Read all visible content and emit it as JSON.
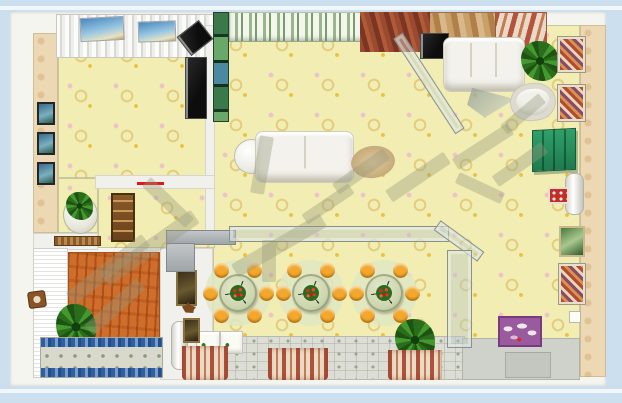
{
  "scene": {
    "type": "3d-interior-floorplan-top-view",
    "background_color": "#cbdfee",
    "panel_color": "#f5f5f0",
    "floor_color": "#f2edb2",
    "wood_floor_color": "#cf6d2a",
    "accent_colors": {
      "stool_orange": "#f3a72c",
      "wardrobe_green": "#2fa06a",
      "flower_red": "#d82c22",
      "rug_blue": "#2f5f9f",
      "red_marker": "#e01818"
    }
  },
  "furniture": [
    {
      "name": "corner-speaker",
      "kind": "tv",
      "x": 181,
      "y": 26,
      "w": 26,
      "h": 22,
      "rot": -38
    },
    {
      "name": "tv-left-room",
      "kind": "tv",
      "x": 185,
      "y": 57,
      "w": 20,
      "h": 60,
      "rot": 0
    },
    {
      "name": "wall-picture-blue-1",
      "kind": "wallpic-blue",
      "x": 37,
      "y": 102,
      "w": 14,
      "h": 19,
      "rot": 0
    },
    {
      "name": "wall-picture-blue-2",
      "kind": "wallpic-blue",
      "x": 37,
      "y": 132,
      "w": 14,
      "h": 19,
      "rot": 0
    },
    {
      "name": "wall-picture-blue-3",
      "kind": "wallpic-blue",
      "x": 37,
      "y": 162,
      "w": 14,
      "h": 19,
      "rot": 0
    },
    {
      "name": "window-sky-poster-1",
      "kind": "wallpic-sky",
      "x": 80,
      "y": 17,
      "w": 42,
      "h": 22,
      "rot": -3
    },
    {
      "name": "window-sky-poster-2",
      "kind": "wallpic-sky",
      "x": 138,
      "y": 21,
      "w": 36,
      "h": 19,
      "rot": -2
    },
    {
      "name": "round-side-table",
      "kind": "round-white",
      "x": 234,
      "y": 139,
      "w": 33,
      "h": 33,
      "rot": 0
    },
    {
      "name": "living-sofa",
      "kind": "sofa2",
      "x": 255,
      "y": 131,
      "w": 97,
      "h": 50,
      "rot": 0
    },
    {
      "name": "oval-rug",
      "kind": "rug-oval",
      "x": 351,
      "y": 146,
      "w": 44,
      "h": 32,
      "rot": -8
    },
    {
      "name": "corner-tv-cabinet",
      "kind": "tv",
      "x": 420,
      "y": 33,
      "w": 27,
      "h": 24,
      "rot": 0
    },
    {
      "name": "top-right-sofa",
      "kind": "sofa3",
      "x": 443,
      "y": 37,
      "w": 80,
      "h": 53,
      "rot": 0
    },
    {
      "name": "potted-plant-study",
      "kind": "plant",
      "x": 521,
      "y": 41,
      "w": 38,
      "h": 40,
      "rot": 0
    },
    {
      "name": "glass-coffee-table",
      "kind": "glass-tri",
      "x": 465,
      "y": 85,
      "w": 52,
      "h": 34,
      "rot": 0
    },
    {
      "name": "tub-chair",
      "kind": "tub",
      "x": 510,
      "y": 83,
      "w": 44,
      "h": 36,
      "rot": -6
    },
    {
      "name": "wall-art-mosaic-1",
      "kind": "wallpic-mosaic",
      "x": 558,
      "y": 37,
      "w": 23,
      "h": 31,
      "rot": 0
    },
    {
      "name": "wall-art-mosaic-2",
      "kind": "wallpic-mosaic",
      "x": 558,
      "y": 85,
      "w": 23,
      "h": 32,
      "rot": 0
    },
    {
      "name": "green-wardrobe",
      "kind": "wardrobe",
      "x": 532,
      "y": 129,
      "w": 42,
      "h": 40,
      "rot": 0
    },
    {
      "name": "water-heater",
      "kind": "cylinder",
      "x": 565,
      "y": 173,
      "w": 17,
      "h": 40,
      "rot": 0
    },
    {
      "name": "small-red-picture",
      "kind": "wallpic-red",
      "x": 548,
      "y": 187,
      "w": 17,
      "h": 13,
      "rot": 0
    },
    {
      "name": "wall-picture-green-right",
      "kind": "wallpic-green",
      "x": 559,
      "y": 226,
      "w": 22,
      "h": 27,
      "rot": 0
    },
    {
      "name": "wall-picture-mosaic-right",
      "kind": "wallpic-mosaic",
      "x": 559,
      "y": 264,
      "w": 22,
      "h": 36,
      "rot": 0
    },
    {
      "name": "light-switch",
      "kind": "switch",
      "x": 569,
      "y": 311,
      "w": 10,
      "h": 10,
      "rot": 0
    },
    {
      "name": "purple-poster",
      "kind": "poster-purple",
      "x": 498,
      "y": 316,
      "w": 40,
      "h": 27,
      "rot": 0
    },
    {
      "name": "potted-plant-dining",
      "kind": "plant",
      "x": 395,
      "y": 319,
      "w": 40,
      "h": 42,
      "rot": 0
    },
    {
      "name": "potted-plant-bedroom",
      "kind": "plant",
      "x": 56,
      "y": 304,
      "w": 40,
      "h": 46,
      "rot": 0
    },
    {
      "name": "plant-pedestal",
      "kind": "pedestal",
      "x": 63,
      "y": 196,
      "w": 33,
      "h": 36,
      "rot": 0
    },
    {
      "name": "pedestal-plant",
      "kind": "plant",
      "x": 66,
      "y": 192,
      "w": 27,
      "h": 28,
      "rot": 0
    },
    {
      "name": "hall-shelf-cabinet",
      "kind": "shelf",
      "x": 111,
      "y": 193,
      "w": 20,
      "h": 45,
      "rot": 0
    },
    {
      "name": "doormat",
      "kind": "doormat",
      "x": 54,
      "y": 236,
      "w": 45,
      "h": 8,
      "rot": 0
    },
    {
      "name": "wall-clock",
      "kind": "clock",
      "x": 28,
      "y": 291,
      "w": 16,
      "h": 15,
      "rot": -8
    },
    {
      "name": "white-cabinet-1",
      "kind": "washer",
      "x": 196,
      "y": 331,
      "w": 22,
      "h": 21,
      "rot": 0
    },
    {
      "name": "white-cabinet-2",
      "kind": "washer",
      "x": 220,
      "y": 331,
      "w": 21,
      "h": 21,
      "rot": 0
    },
    {
      "name": "hall-radiator",
      "kind": "cylinder",
      "x": 171,
      "y": 321,
      "w": 15,
      "h": 47,
      "rot": 0
    },
    {
      "name": "hall-picture-dark",
      "kind": "wallpic-dark",
      "x": 176,
      "y": 270,
      "w": 17,
      "h": 32,
      "rot": 0
    },
    {
      "name": "deer-figurine",
      "kind": "deer",
      "x": 182,
      "y": 302,
      "w": 14,
      "h": 11,
      "rot": 0
    },
    {
      "name": "hall-picture-small",
      "kind": "wallpic-dark",
      "x": 183,
      "y": 318,
      "w": 13,
      "h": 21,
      "rot": 0
    },
    {
      "name": "red-wall-marker",
      "kind": "redline",
      "x": 137,
      "y": 182,
      "w": 27,
      "h": 3,
      "rot": 0
    },
    {
      "name": "kitchen-counter-long",
      "kind": "counter",
      "x": 166,
      "y": 230,
      "w": 68,
      "h": 13,
      "rot": 0
    },
    {
      "name": "kitchen-counter-short",
      "kind": "counter",
      "x": 166,
      "y": 243,
      "w": 27,
      "h": 27,
      "rot": 0
    },
    {
      "name": "glass-partition-long",
      "kind": "glass",
      "x": 229,
      "y": 226,
      "w": 218,
      "h": 14,
      "rot": 0
    },
    {
      "name": "glass-partition-corner",
      "kind": "glass",
      "x": 432,
      "y": 235,
      "w": 52,
      "h": 10,
      "rot": 36
    },
    {
      "name": "glass-door",
      "kind": "glass",
      "x": 447,
      "y": 250,
      "w": 23,
      "h": 96,
      "rot": 0
    },
    {
      "name": "glass-partition-diagonal",
      "kind": "glass",
      "x": 372,
      "y": 78,
      "w": 112,
      "h": 9,
      "rot": 57
    },
    {
      "name": "entry-mat",
      "kind": "mat",
      "x": 505,
      "y": 352,
      "w": 44,
      "h": 24,
      "rot": 0
    },
    {
      "name": "striped-drape-1",
      "kind": "drape",
      "x": 182,
      "y": 346,
      "w": 46,
      "h": 34,
      "rot": 0
    },
    {
      "name": "striped-drape-2",
      "kind": "drape",
      "x": 268,
      "y": 348,
      "w": 60,
      "h": 32,
      "rot": 0
    },
    {
      "name": "striped-drape-3",
      "kind": "drape",
      "x": 388,
      "y": 350,
      "w": 54,
      "h": 30,
      "rot": 0
    },
    {
      "name": "bed-rug",
      "kind": "bedrug",
      "x": 40,
      "y": 337,
      "w": 121,
      "h": 39,
      "rot": 0
    }
  ],
  "dining": {
    "tables": [
      {
        "cx": 238,
        "cy": 293
      },
      {
        "cx": 311,
        "cy": 293
      },
      {
        "cx": 384,
        "cy": 293
      }
    ],
    "stool_angles": [
      0,
      55,
      125,
      180,
      235,
      305
    ],
    "ring_radius": 28,
    "stool_size": 15,
    "table_size": 38,
    "rug_size": 66,
    "flower_size": 16,
    "stool_color": "#f3a72c",
    "table_color": "#ccd6ae",
    "rug_color": "#dfe6c2"
  },
  "watermark": {
    "color": "rgba(150,152,126,0.38)",
    "bars": [
      {
        "x": 95,
        "y": 240,
        "w": 110,
        "h": 16,
        "rot": -35
      },
      {
        "x": 60,
        "y": 262,
        "w": 96,
        "h": 15,
        "rot": -38
      },
      {
        "x": 80,
        "y": 300,
        "w": 70,
        "h": 14,
        "rot": -42
      },
      {
        "x": 138,
        "y": 196,
        "w": 60,
        "h": 13,
        "rot": 44
      },
      {
        "x": 255,
        "y": 136,
        "w": 14,
        "h": 58,
        "rot": 10
      },
      {
        "x": 228,
        "y": 238,
        "w": 102,
        "h": 15,
        "rot": -30
      },
      {
        "x": 262,
        "y": 240,
        "w": 14,
        "h": 42,
        "rot": 0
      },
      {
        "x": 300,
        "y": 198,
        "w": 56,
        "h": 12,
        "rot": -34
      },
      {
        "x": 330,
        "y": 165,
        "w": 62,
        "h": 13,
        "rot": -35
      },
      {
        "x": 383,
        "y": 170,
        "w": 70,
        "h": 14,
        "rot": -34
      },
      {
        "x": 450,
        "y": 140,
        "w": 66,
        "h": 13,
        "rot": -33
      },
      {
        "x": 490,
        "y": 158,
        "w": 60,
        "h": 13,
        "rot": -35
      },
      {
        "x": 498,
        "y": 108,
        "w": 50,
        "h": 12,
        "rot": -40
      },
      {
        "x": 455,
        "y": 182,
        "w": 50,
        "h": 12,
        "rot": 25
      }
    ]
  }
}
